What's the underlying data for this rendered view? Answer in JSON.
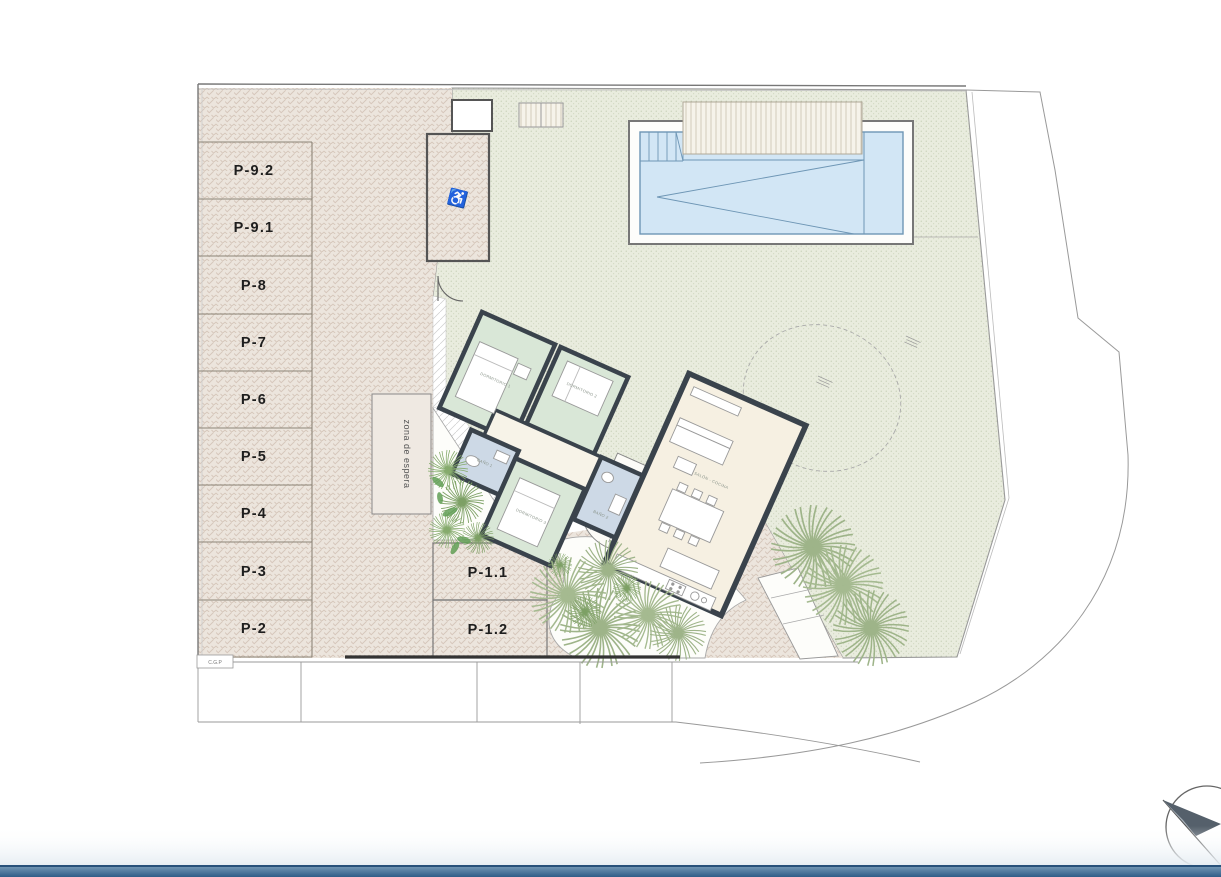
{
  "plan": {
    "parking": {
      "left_column": [
        "P-9.2",
        "P-9.1",
        "P-8",
        "P-7",
        "P-6",
        "P-5",
        "P-4",
        "P-3",
        "P-2"
      ],
      "front": [
        "P-1.1",
        "P-1.2"
      ],
      "disabled_icon": "♿"
    },
    "annotations": {
      "waiting_zone": "zona de espera",
      "cgp": "C.G.P"
    },
    "rooms": {
      "bedroom1": "DORMITORIO 1",
      "bedroom2": "DORMITORIO 2",
      "bedroom3": "DORMITORIO 3",
      "bath1": "BAÑO 1",
      "bath2": "BAÑO 2",
      "living": "SALÓN - COCINA"
    },
    "icons": {
      "compass": "north-compass",
      "palm": "palm-tree",
      "wheelchair": "disabled-parking"
    },
    "colors": {
      "paving_herringbone": "#ece5dd",
      "paving_texture_stroke": "#d5c6ba",
      "terrace_dots": "#e9ecde",
      "pool_water": "#d2e6f5",
      "pool_edge": "#6e96b5",
      "bedroom_green": "#d9e7d7",
      "bathroom_blue": "#cdd9e6",
      "living_cream": "#f6f0e2",
      "wall_dark": "#3a434c",
      "footer_bar": "#40719b",
      "plants_green": "#9eb489"
    }
  }
}
